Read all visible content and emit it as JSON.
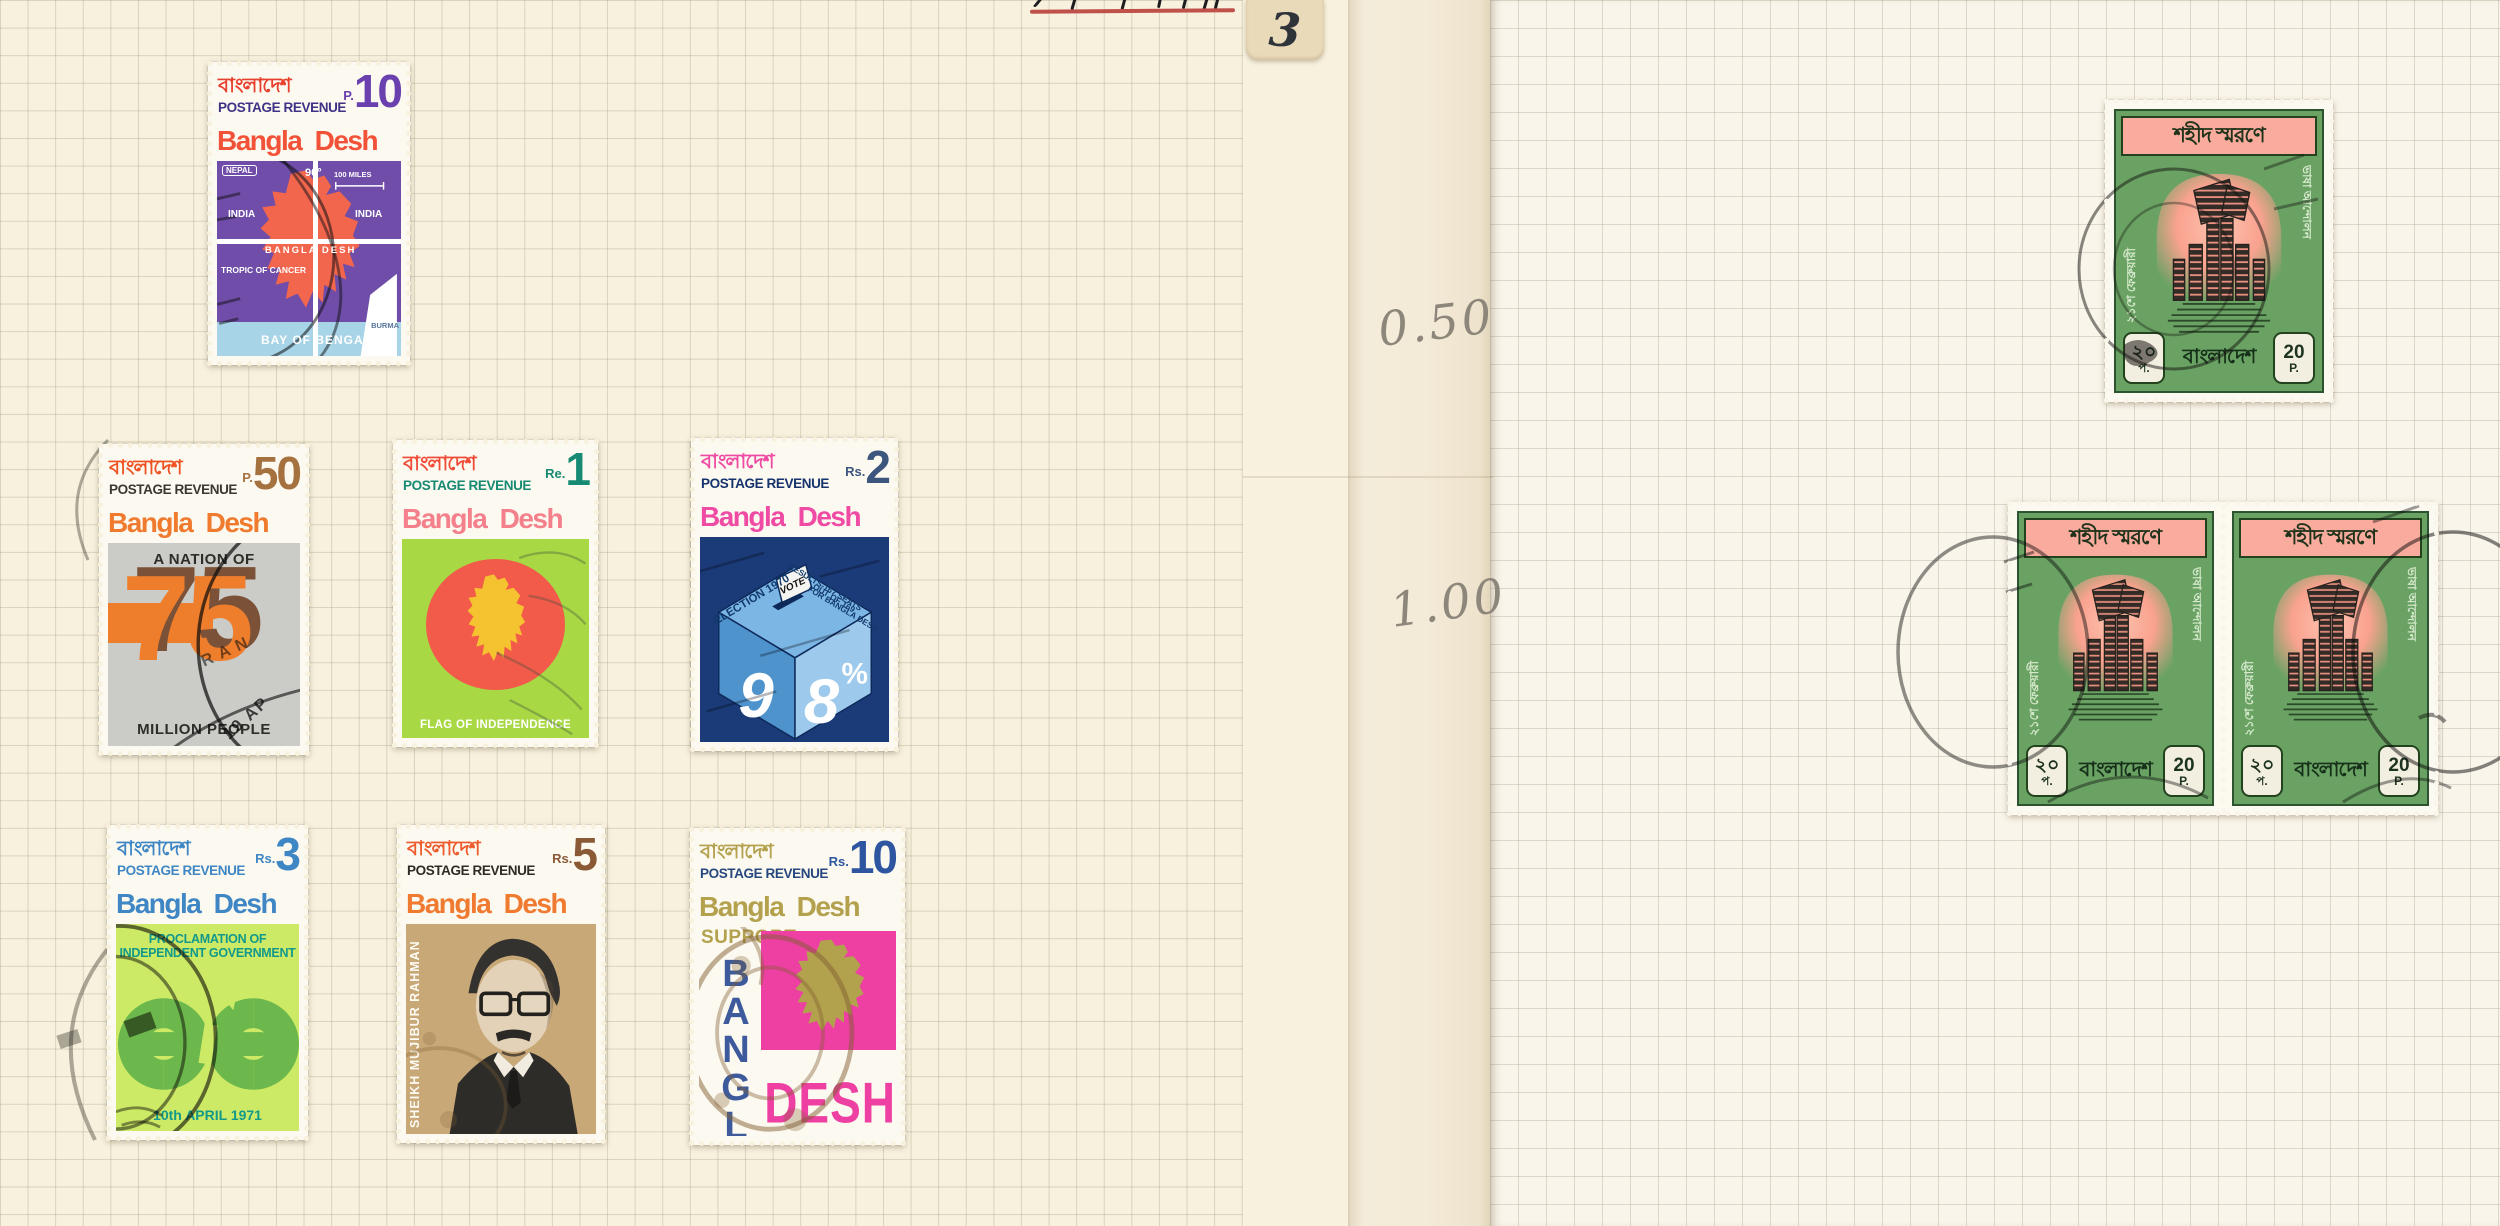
{
  "page": {
    "tab": {
      "label": "3",
      "bg": "#e9dab9"
    },
    "pencil_notes": {
      "upper": "0.50",
      "lower": "1.00"
    },
    "top_note_underline_color": "#c0504a",
    "left_bg": "#f7f1de",
    "right_bg": "#faf5ea",
    "gutter_bg": "#f2e9d6"
  },
  "stamps": {
    "p10": {
      "bengali": "বাংলাদেশ",
      "series": "POSTAGE REVENUE",
      "denom_prefix": "P.",
      "denom": "10",
      "country": "Bangla Desh",
      "labels": {
        "nepal": "NEPAL",
        "meridian": "90°",
        "scale": "100 MILES",
        "india_west": "INDIA",
        "india_east": "INDIA",
        "bangla_desh": "BANGLA DESH",
        "tropic": "TROPIC OF CANCER",
        "bay": "BAY OF BENGAL",
        "burma": "BURMA"
      },
      "colors": {
        "panel": "#6f4da8",
        "map": "#f2664d",
        "sea": "#a7d4e6"
      }
    },
    "p50": {
      "bengali": "বাংলাদেশ",
      "series": "POSTAGE REVENUE",
      "denom_prefix": "P.",
      "denom": "50",
      "country": "Bangla Desh",
      "caption_top": "A NATION OF",
      "big_number": "75",
      "caption_bottom": "MILLION PEOPLE",
      "postmark_arc": "RAN",
      "postmark_date": "19 AP",
      "colors": {
        "panel": "#cbcbc7",
        "number": "#ef7e2c",
        "shadow": "#7b5238"
      }
    },
    "re1": {
      "bengali": "বাংলাদেশ",
      "series": "POSTAGE REVENUE",
      "denom_prefix": "Re.",
      "denom": "1",
      "country": "Bangla Desh",
      "caption": "FLAG OF INDEPENDENCE",
      "colors": {
        "panel": "#a8d944",
        "disc": "#f25a4a",
        "map": "#f6c330"
      }
    },
    "rs2": {
      "bengali": "বাংলাদেশ",
      "series": "POSTAGE REVENUE",
      "denom_prefix": "Rs.",
      "denom": "2",
      "country": "Bangla Desh",
      "cube_left": "ELECTION 1970",
      "cube_right_line1": "RESULTS-167 SEATS",
      "cube_right_line2": "OUT OF 169",
      "cube_right_line3": "FOR BANGLA DESH",
      "vote": "VOTE",
      "digit_left": "9",
      "digit_right": "8",
      "digit_right_pct": "%",
      "colors": {
        "panel": "#1b3a78",
        "face_top": "#7cb6e4",
        "face_left": "#4e93cc",
        "face_right": "#9dcaec"
      }
    },
    "rs3": {
      "bengali": "বাংলাদেশ",
      "series": "POSTAGE REVENUE",
      "denom_prefix": "Rs.",
      "denom": "3",
      "country": "Bangla Desh",
      "caption_line1": "PROCLAMATION OF",
      "caption_line2": "INDEPENDENT GOVERNMENT",
      "date": "10th APRIL 1971",
      "colors": {
        "panel": "#cdea67",
        "chain": "#6cb84c",
        "caption": "#12998a"
      }
    },
    "rs5": {
      "bengali": "বাংলাদেশ",
      "series": "POSTAGE REVENUE",
      "denom_prefix": "Rs.",
      "denom": "5",
      "country": "Bangla Desh",
      "side_text": "SHEIKH MUJIBUR RAHMAN",
      "colors": {
        "panel": "#c9a878"
      }
    },
    "rs10": {
      "bengali": "বাংলাদেশ",
      "series": "POSTAGE REVENUE",
      "denom_prefix": "Rs.",
      "denom": "10",
      "country": "Bangla Desh",
      "support": "SUPPORT",
      "bangla": "BANGLA",
      "desh": "DESH",
      "colors": {
        "pink": "#ee3fa2",
        "blue": "#3c5a9c",
        "gold": "#b2a24e"
      }
    },
    "p20": {
      "header": "শহীদ স্মরণে",
      "side_left": "২১শে ফেব্রুয়ারী",
      "side_right": "ভাষা আন্দোলন",
      "country": "বাংলাদেশ",
      "value_bn": "২০",
      "value_bn_unit": "প.",
      "value_en": "20",
      "value_en_unit": "P.",
      "colors": {
        "body": "#6aa263",
        "band": "#f9ab9e",
        "frame": "#23431f"
      }
    }
  }
}
